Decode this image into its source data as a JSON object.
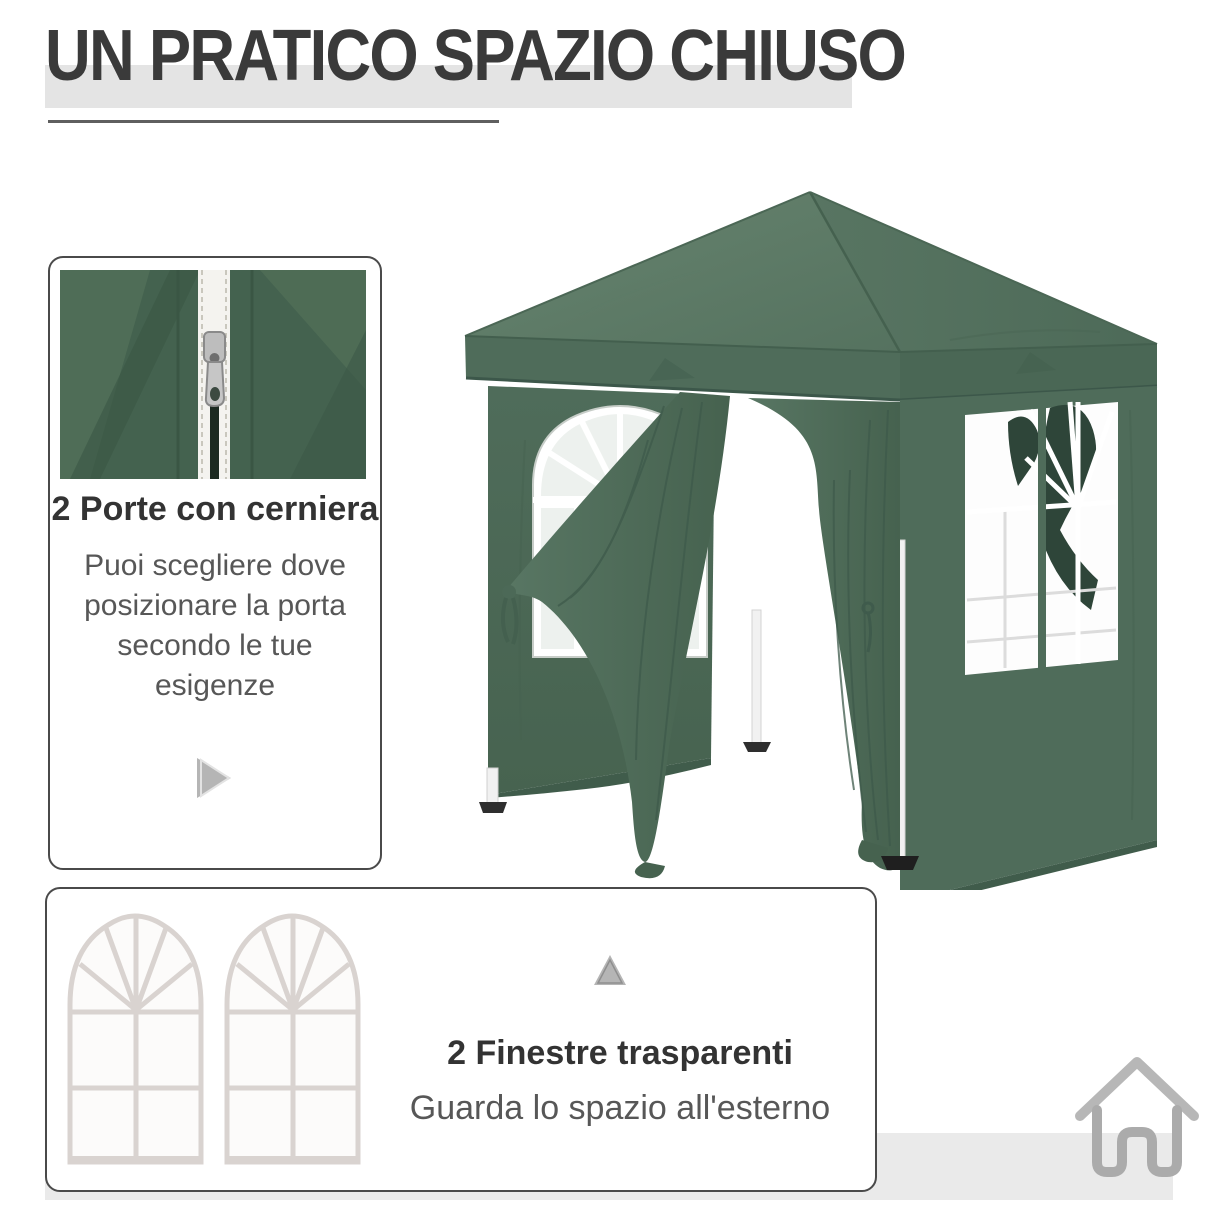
{
  "page": {
    "title": "UN PRATICO SPAZIO CHIUSO"
  },
  "features": {
    "doors": {
      "heading": "2 Porte con cerniera",
      "body": "Puoi scegliere dove\nposizionare la porta\nsecondo le tue\nesigenze"
    },
    "windows": {
      "heading": "2 Finestre trasparenti",
      "body": "Guarda lo spazio all'esterno"
    }
  },
  "icons": {
    "doors_card_icon": "play-triangle-icon",
    "windows_card_icon": "up-triangle-icon",
    "brand_logo": "house-icon"
  },
  "colors": {
    "title_text": "#3a3a3a",
    "title_highlight_band": "#e4e4e4",
    "title_underline": "#5f5f5f",
    "card_border": "#4a4a4a",
    "heading_text": "#333333",
    "body_text": "#575757",
    "triangle_icon": "#b5b5b5",
    "bottom_band": "#eaeaea",
    "logo_gray": "#afafaf",
    "tent_green_wall": "#4d6b59",
    "tent_green_roof": "#5e7c68",
    "tent_green_dark": "#3e5a4b",
    "window_frame": "#ffffff"
  }
}
